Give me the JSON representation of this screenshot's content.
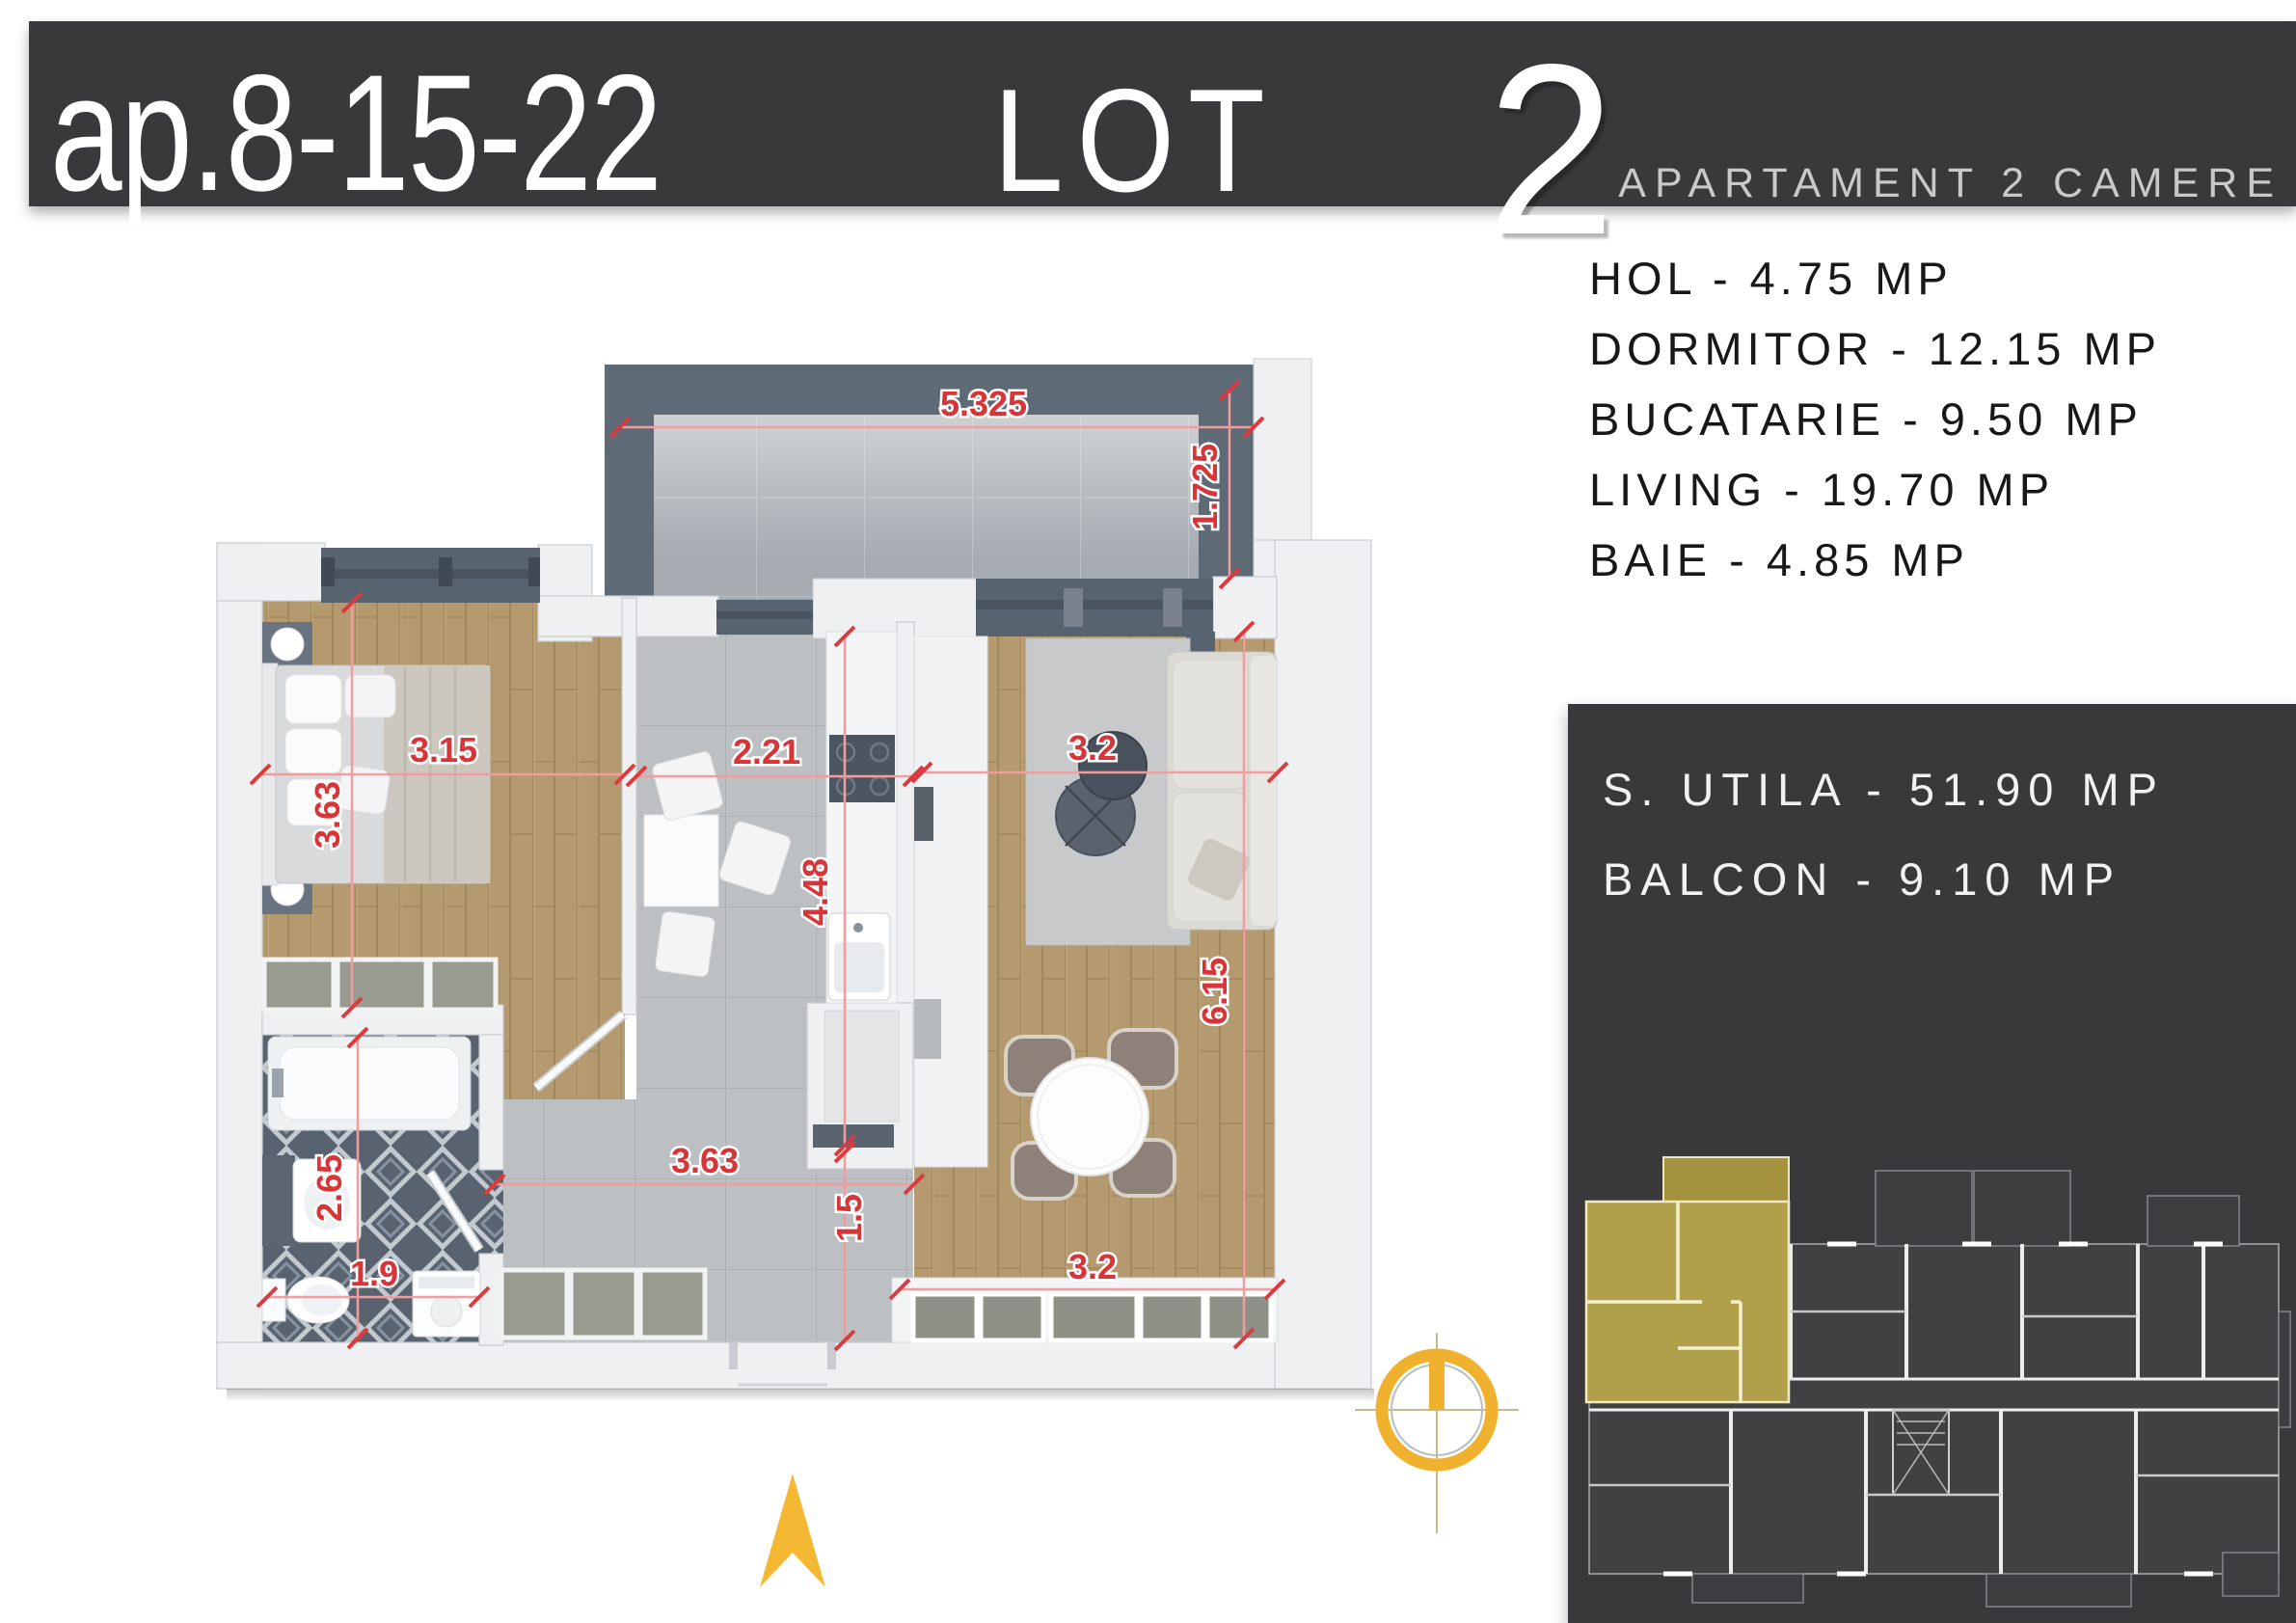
{
  "header": {
    "apartment_label": "ap.8-15-22",
    "lot_label": "LOT",
    "lot_number": "2",
    "subtitle": "APARTAMENT 2 CAMERE"
  },
  "room_list": [
    "HOL - 4.75 MP",
    "DORMITOR - 12.15 MP",
    "BUCATARIE - 9.50 MP",
    "LIVING - 19.70 MP",
    "BAIE - 4.85 MP"
  ],
  "summary": [
    "S. UTILA - 51.90 MP",
    "BALCON - 9.10 MP"
  ],
  "plan": {
    "dimension_labels": [
      "5.325",
      "1.725",
      "3.15",
      "3.63",
      "2.21",
      "4.48",
      "3.2",
      "6.15",
      "2.65",
      "1.9",
      "3.63",
      "1.5",
      "3.2"
    ]
  },
  "colors": {
    "banner": "#39393b",
    "dimension_red": "#d93438",
    "north_yellow": "#f5b832",
    "highlight_unit": "#b1a04a"
  }
}
